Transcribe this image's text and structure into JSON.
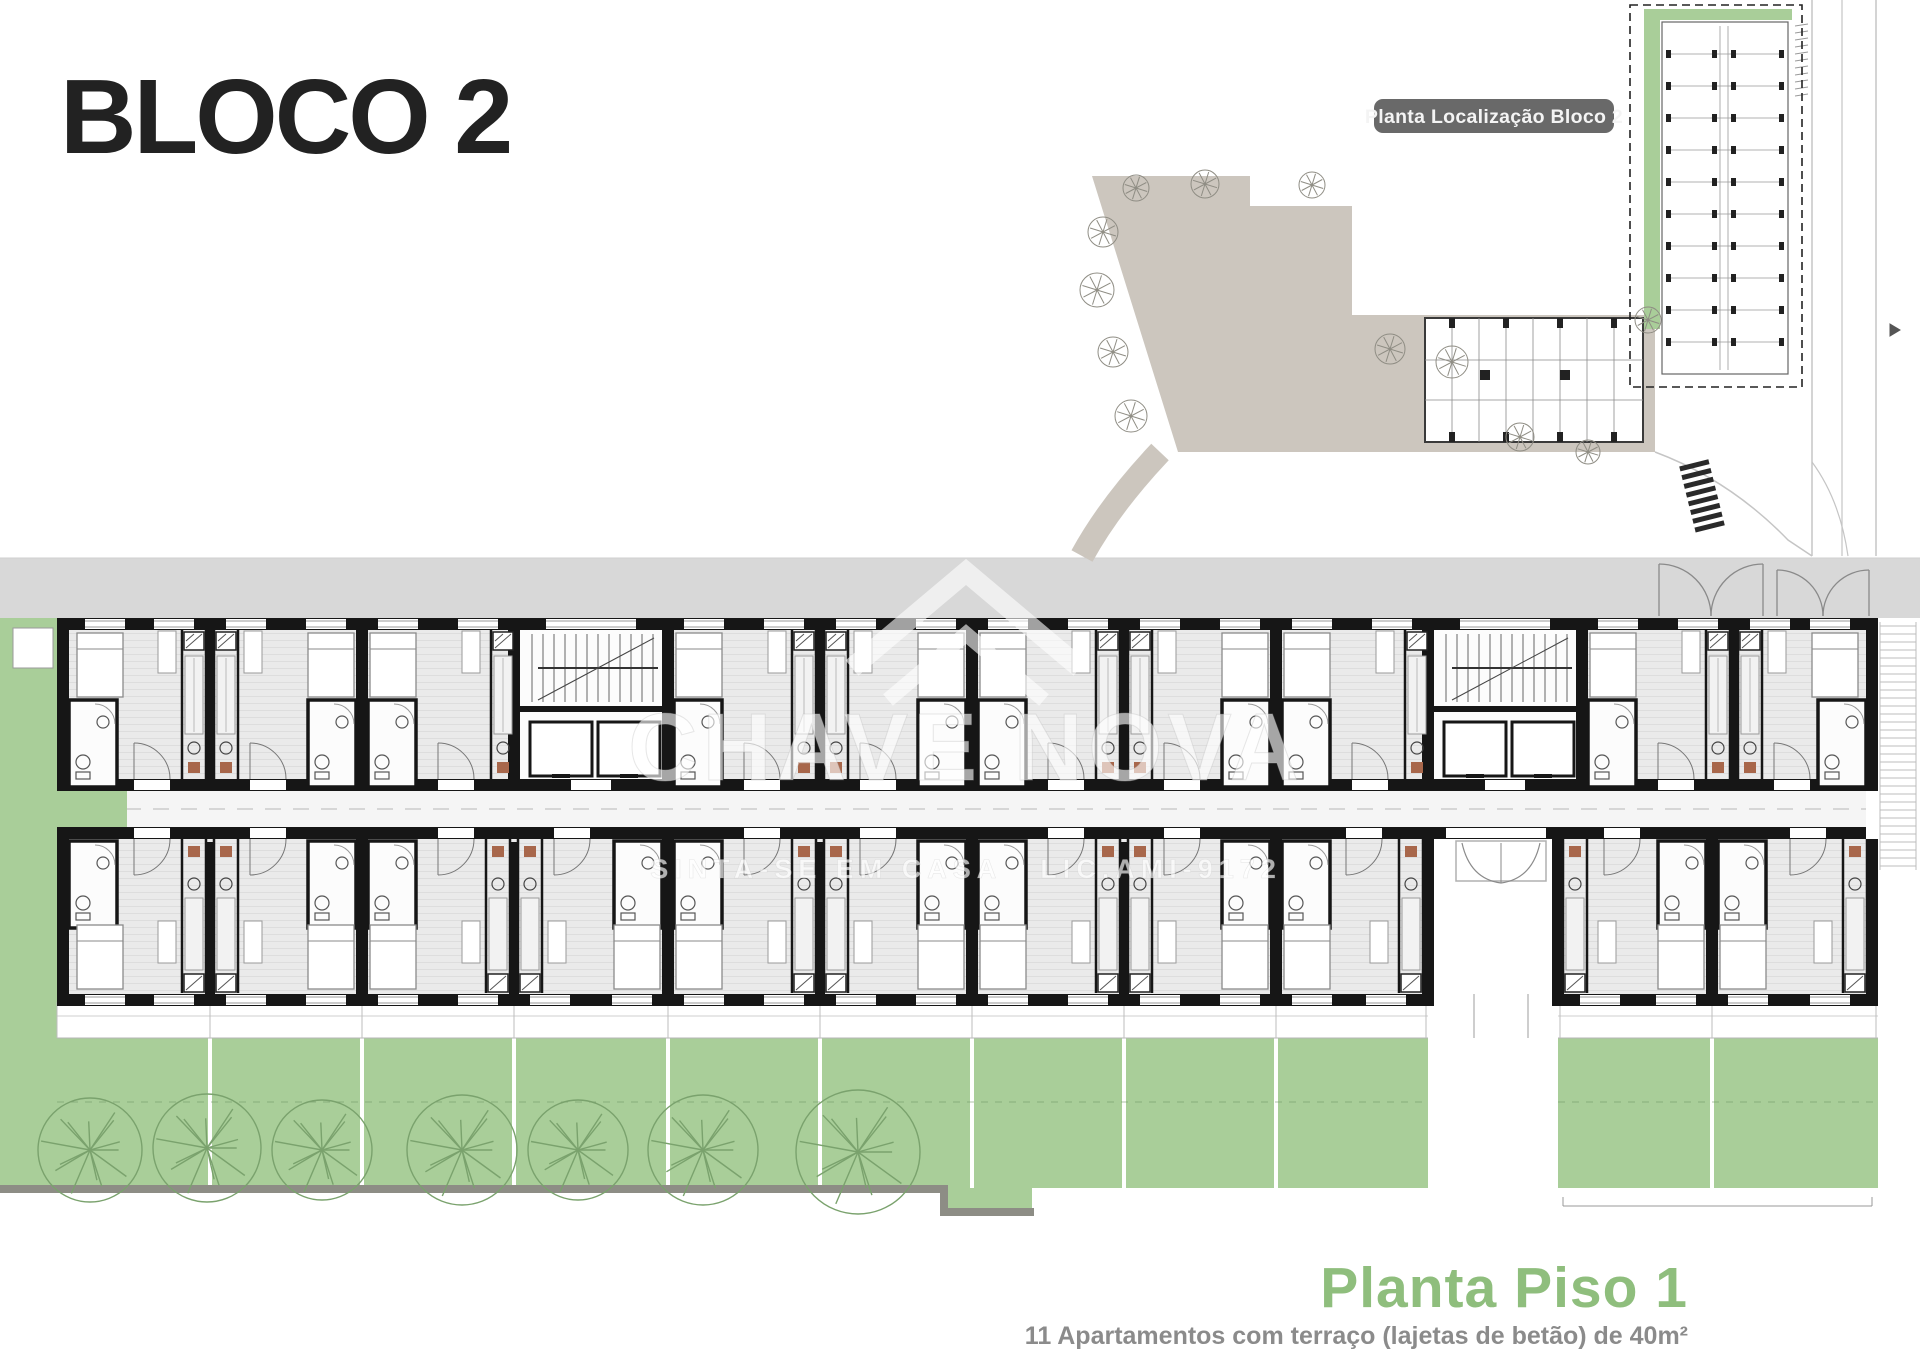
{
  "page": {
    "title": "BLOCO 2"
  },
  "site_plan": {
    "label": "Planta Localização Bloco 2"
  },
  "watermark": {
    "brand": "CHAVE NOVA",
    "tagline": "SINTA-SE EM CASA",
    "license": "LIC.AMI-9172"
  },
  "footer": {
    "title": "Planta Piso 1",
    "subtitle": "11 Apartamentos com terraço (lajetas de betão) de 40m²"
  },
  "colors": {
    "garden_green": "#a9ce99",
    "tree_green": "#7aa26d",
    "title_green": "#8fbe7d",
    "band_gray": "#d8d8d8",
    "plaza_beige": "#ccc6be",
    "wall": "#161616",
    "label_pill": "#696969",
    "subtitle_gray": "#8b8b8b",
    "accent_rust": "#a8674b",
    "sidewalk_gray": "#8d8d85"
  }
}
